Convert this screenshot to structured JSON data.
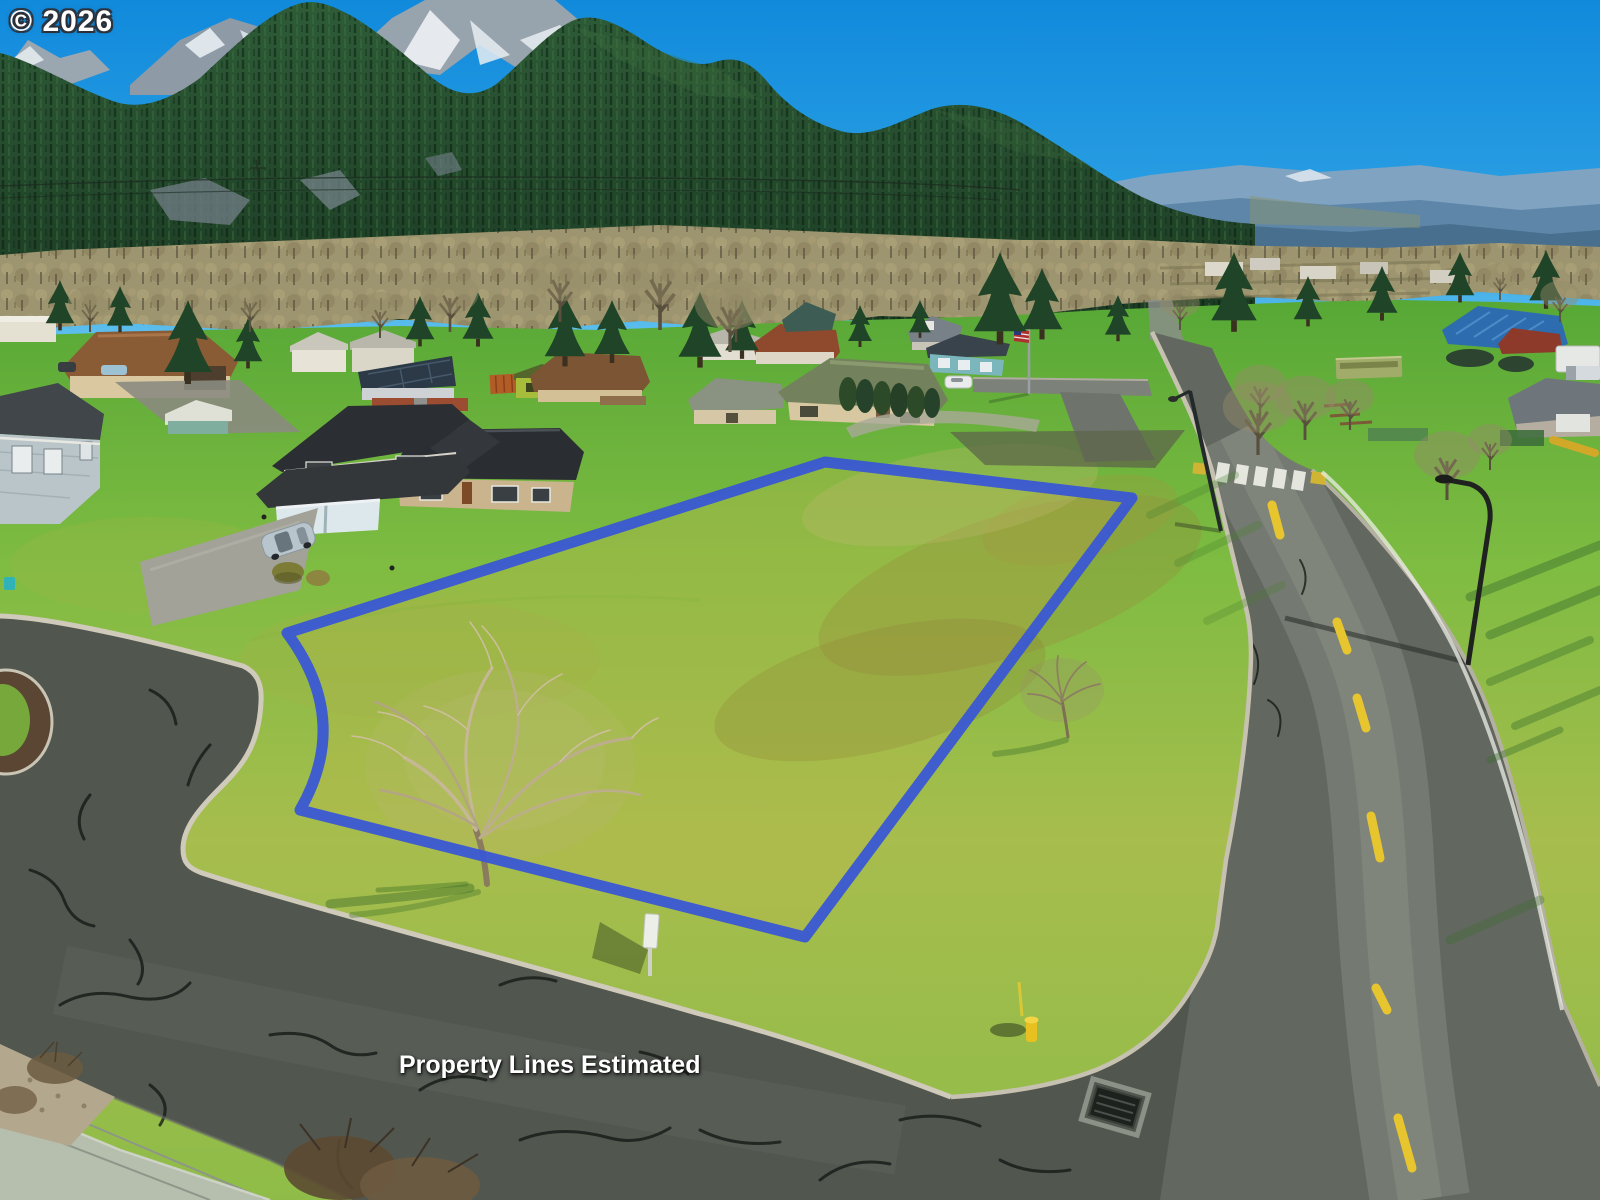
{
  "watermarks": {
    "copyright": "© 2026",
    "disclaimer": "Property Lines Estimated"
  },
  "boundary": {
    "color": "#3a57d4"
  },
  "palette": {
    "sky": "#1f97dd",
    "mountain_forest": "#24452b",
    "distant_ridge": "#5d86a8",
    "lawn_green": "#76b83e",
    "field_yellow_green": "#b4b94f",
    "main_road": "#62675f",
    "side_street": "#4b504b",
    "curb": "#c9c4b2",
    "center_line_yellow": "#e6c52e",
    "hydrant_yellow": "#e8c020",
    "crosswalk_white": "#eef0e8"
  }
}
